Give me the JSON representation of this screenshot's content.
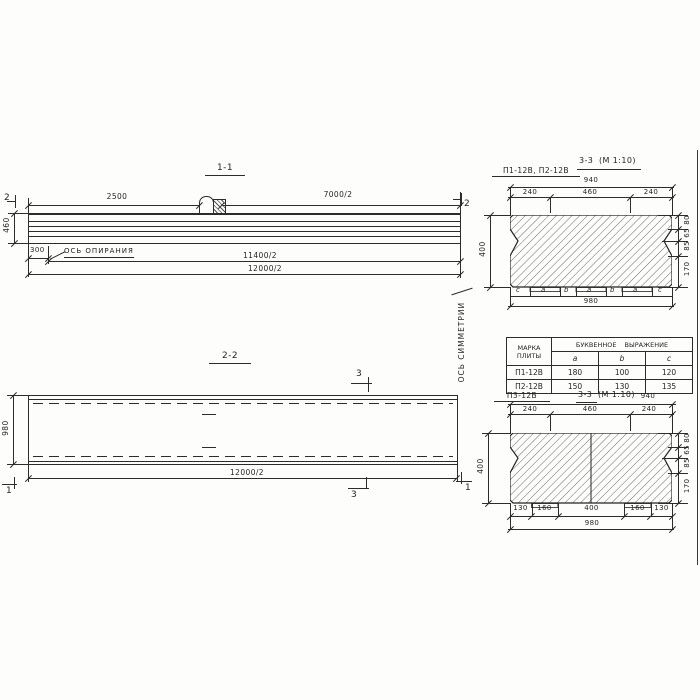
{
  "drawing": {
    "s11": {
      "title": "1-1",
      "dim_2500": "2500",
      "dim_7000": "7000/2",
      "cut_left": "2",
      "cut_right": "2",
      "dim_460": "460",
      "dim_300": "300",
      "axis_support": "ОСЬ ОПИРАНИЯ",
      "dim_11400": "11400/2",
      "dim_12000": "12000/2"
    },
    "axis_symmetry": "ОСЬ СИММЕТРИИ",
    "s22": {
      "title": "2-2",
      "cut3": "3",
      "cut1": "1",
      "dim_980": "980",
      "dim_12000": "12000/2"
    },
    "s33a": {
      "label": "П1-12В, П2-12В",
      "title": "3-3",
      "scale": "(М 1:10)",
      "dim_940": "940",
      "dim_240l": "240",
      "dim_460": "460",
      "dim_240r": "240",
      "dim_400": "400",
      "right_dims": [
        "80",
        "65",
        "85",
        "170"
      ],
      "letters": [
        "c",
        "a",
        "b",
        "a",
        "b",
        "a",
        "c"
      ],
      "dim_980": "980"
    },
    "table": {
      "header_marka": "МАРКА ПЛИТЫ",
      "header_group": "БУКВЕННОЕ ВЫРАЖЕНИЕ",
      "cols": [
        "a",
        "b",
        "c"
      ],
      "rows": [
        [
          "П1-12В",
          "180",
          "100",
          "120"
        ],
        [
          "П2-12В",
          "150",
          "130",
          "135"
        ]
      ]
    },
    "s33b": {
      "label": "П3-12В",
      "title": "3-3",
      "scale": "(М 1:10)",
      "dim_940": "940",
      "dim_240l": "240",
      "dim_460": "460",
      "dim_240r": "240",
      "dim_400": "400",
      "right_dims": [
        "80",
        "65",
        "85",
        "170"
      ],
      "bottom_dims": [
        "130",
        "160",
        "400",
        "160",
        "130"
      ],
      "dim_980": "980"
    }
  }
}
